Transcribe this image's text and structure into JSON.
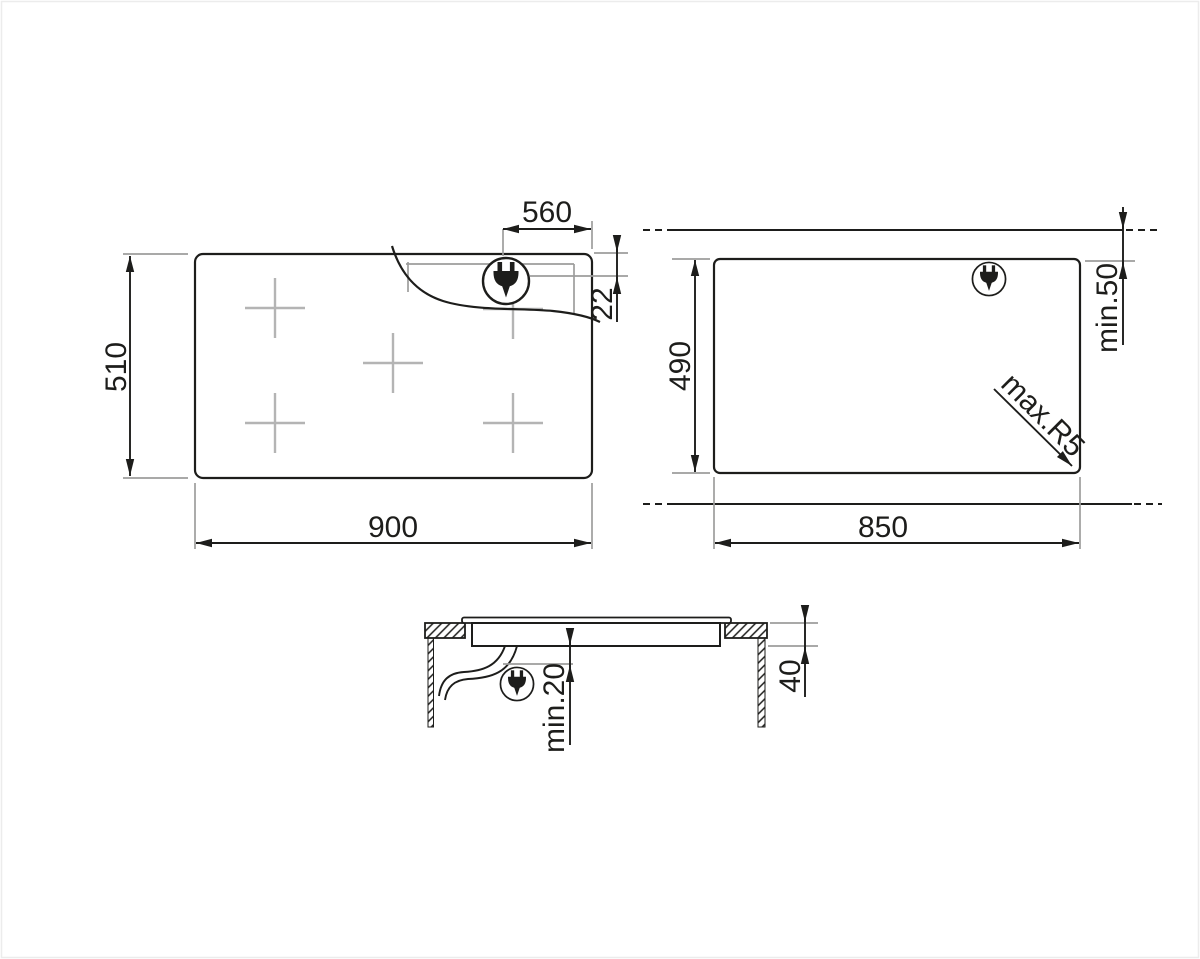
{
  "drawing": {
    "hob_plan": {
      "width": "900",
      "depth": "510",
      "plug_to_edge": "560",
      "plug_offset_from_top": "22",
      "burner_marks": 5
    },
    "cutout_plan": {
      "width": "850",
      "depth": "490",
      "min_rear_clearance": "min.50",
      "max_corner_radius": "max.R5"
    },
    "section_view": {
      "min_clearance_below": "min.20",
      "recess_depth": "40"
    },
    "icons": {
      "plug": "power-plug"
    },
    "colors": {
      "line": "#1d1d1b",
      "extension_line": "#9d9d9c",
      "burner_mark": "#b4b4b4",
      "background": "#ffffff"
    }
  }
}
